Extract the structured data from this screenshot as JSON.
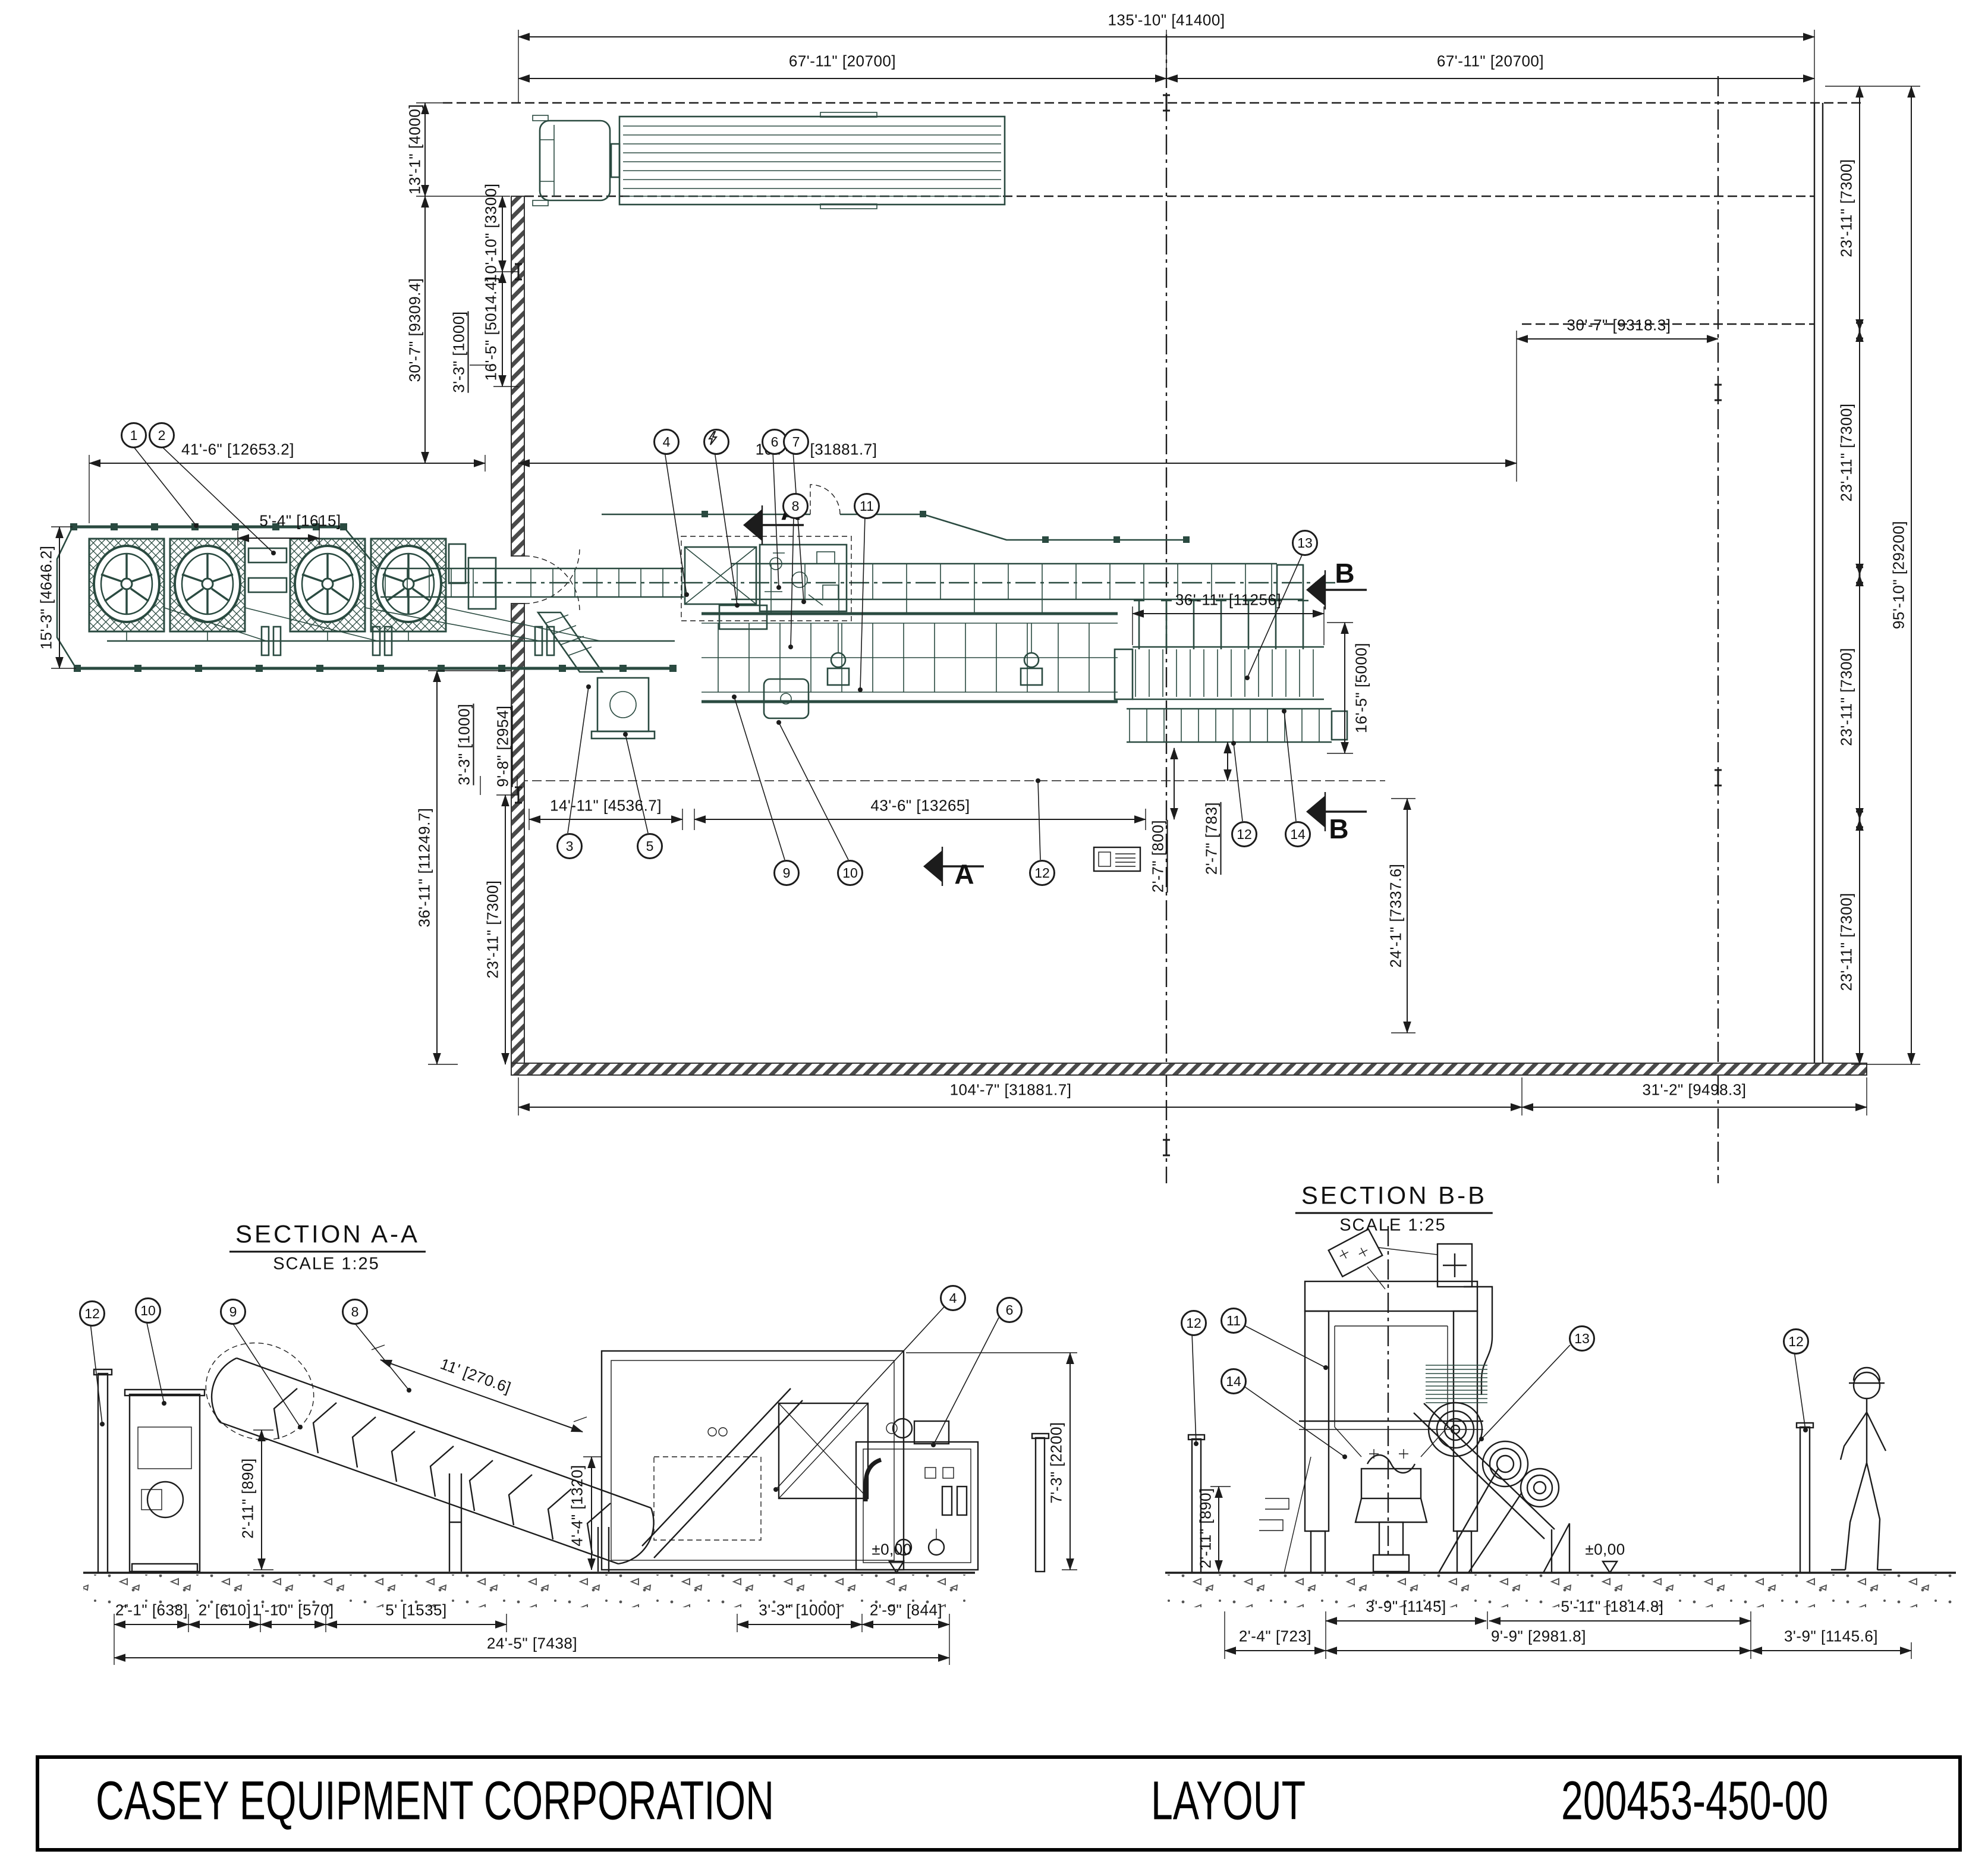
{
  "drawing": {
    "company": "CASEY EQUIPMENT CORPORATION",
    "sheet_title": "LAYOUT",
    "drawing_number": "200453-450-00"
  },
  "plan": {
    "dims": {
      "overall_width": "135'-10\" [41400]",
      "bay_left": "67'-11\" [20700]",
      "bay_right": "67'-11\" [20700]",
      "truck_lane": "13'-1\" [4000]",
      "hall_depth": "30'-7\" [9309.4]",
      "wall_seg_a": "10'-10\" [3300]",
      "wall_seg_b": "16'-5\" [5014.4]",
      "wall_offset": "3'-3\" [1000]",
      "platform_len": "41'-6\" [12653.2]",
      "platform_wid": "15'-3\" [4646.2]",
      "fan_gap": "5'-4\" [1615]",
      "line_len": "104'-7\" [31881.7]",
      "right_offset": "30'-7\" [9318.3]",
      "infeed_len": "14'-11\" [4536.7]",
      "mill_len": "43'-6\" [13265]",
      "rack_len": "36'-11\" [11256]",
      "rack_wid": "16'-5\" [5000]",
      "edge_off_a": "2'-7\" [800]",
      "edge_off_b": "2'-7\" [783]",
      "south_clear": "24'-1\" [7337.6]",
      "lower_off_a": "3'-3\" [1000]",
      "lower_off_b": "9'-8\" [2954]",
      "lower_depth_a": "36'-11\" [11249.7]",
      "lower_depth_b": "23'-11\" [7300]",
      "bottom_len": "104'-7\" [31881.7]",
      "bottom_right": "31'-2\" [9498.3]",
      "col_bay_1": "23'-11\" [7300]",
      "col_bay_2": "23'-11\" [7300]",
      "col_bay_3": "23'-11\" [7300]",
      "col_bay_4": "23'-11\" [7300]",
      "overall_depth": "95'-10\" [29200]"
    },
    "section_marks": {
      "a": "A",
      "b": "B"
    }
  },
  "balloons": {
    "1": "1",
    "2": "2",
    "3": "3",
    "4": "4",
    "5": "5",
    "6": "6",
    "7": "7",
    "8": "8",
    "9": "9",
    "10": "10",
    "11": "11",
    "12": "12",
    "13": "13",
    "14": "14"
  },
  "section_a": {
    "title": "SECTION A-A",
    "scale": "SCALE 1:25",
    "dims": {
      "motor_h": "2'-11\" [890]",
      "belt": "11' [270.6]",
      "discharge_h": "4'-4\" [1320]",
      "cabinet_h": "7'-3\" [2200]",
      "level": "±0,00",
      "d1": "2'-1\" [638]",
      "d2": "2' [610]",
      "d3": "1'-10\" [570]",
      "d4": "5' [1535]",
      "d5": "3'-3\" [1000]",
      "d6": "2'-9\" [844]",
      "total": "24'-5\" [7438]"
    }
  },
  "section_b": {
    "title": "SECTION B-B",
    "scale": "SCALE 1:25",
    "dims": {
      "post_h": "2'-11\" [890]",
      "level": "±0,00",
      "d1": "3'-9\" [1145]",
      "d2": "5'-11\" [1814.8]",
      "d3": "2'-4\" [723]",
      "d4": "9'-9\" [2981.8]",
      "d5": "3'-9\" [1145.6]"
    }
  }
}
